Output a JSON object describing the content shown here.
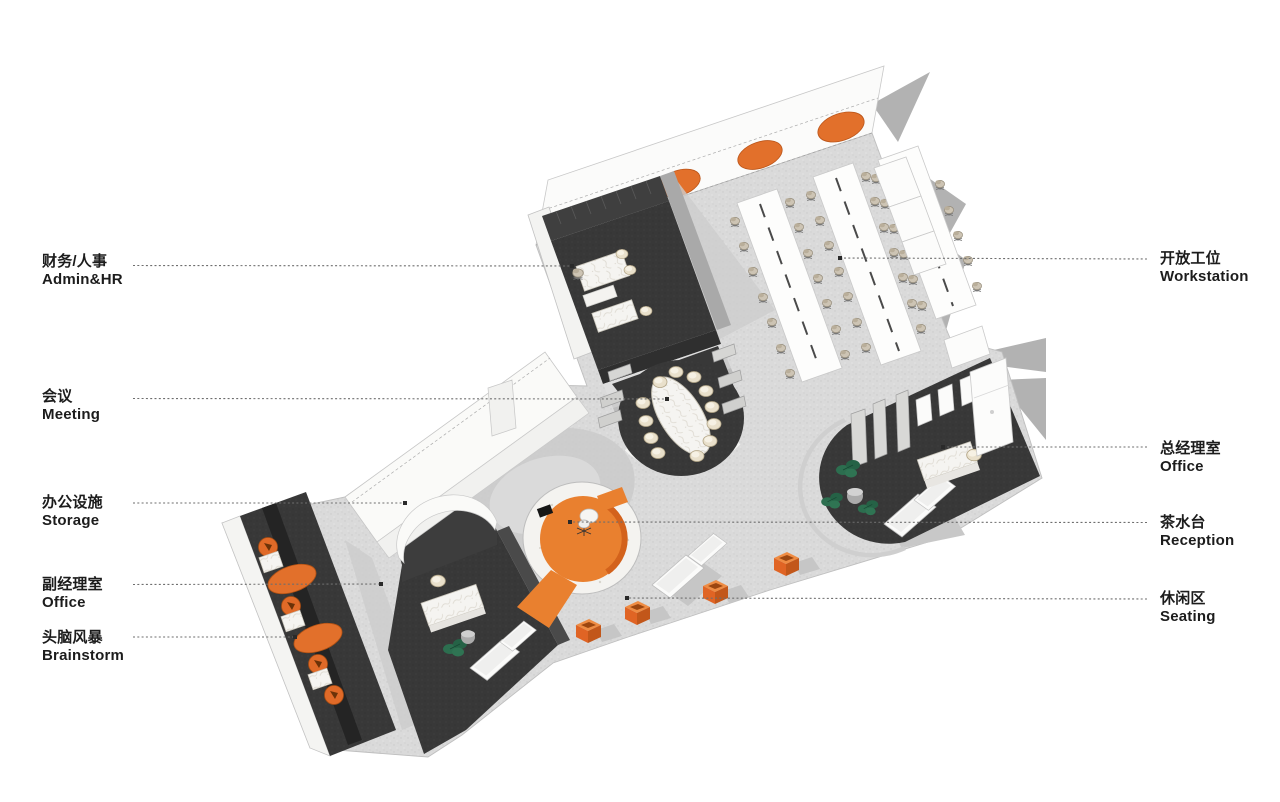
{
  "diagram": {
    "type": "axonometric office floor plan",
    "background": "#ffffff",
    "accent_orange": "#e2702b",
    "dark_room": "#383838",
    "floor_gray": "#dadada",
    "plant_green": "#2c6e4f",
    "legend_left": [
      {
        "zh": "财务/人事",
        "en": "Admin&HR"
      },
      {
        "zh": "会议",
        "en": "Meeting"
      },
      {
        "zh": "办公设施",
        "en": "Storage"
      },
      {
        "zh": "副经理室",
        "en": "Office"
      },
      {
        "zh": "头脑风暴",
        "en": "Brainstorm"
      }
    ],
    "legend_right": [
      {
        "zh": "开放工位",
        "en": "Workstation"
      },
      {
        "zh": "总经理室",
        "en": "Office"
      },
      {
        "zh": "茶水台",
        "en": "Reception"
      },
      {
        "zh": "休闲区",
        "en": "Seating"
      }
    ]
  }
}
